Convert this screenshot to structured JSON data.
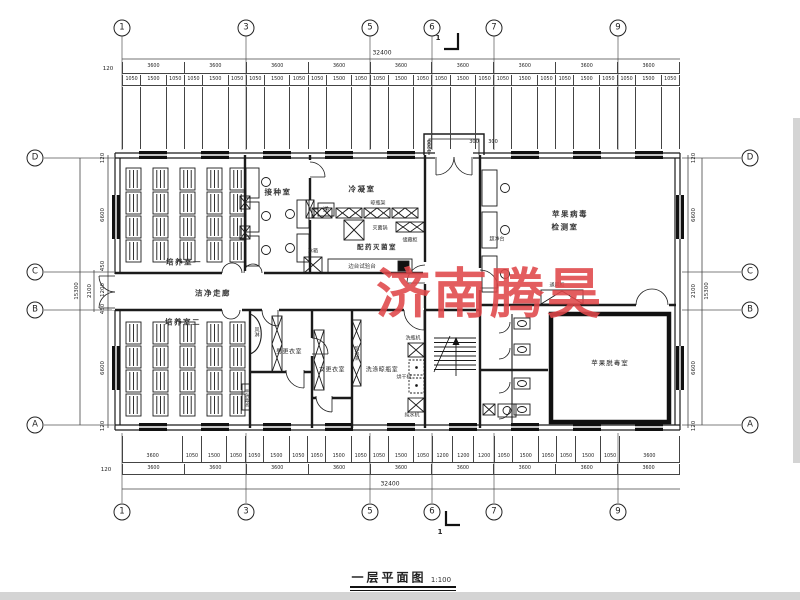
{
  "page": {
    "watermark": "济南腾昊",
    "watermark_color": "#e0474a",
    "title": "一层平面图",
    "scale": "1:100",
    "section_mark": "1"
  },
  "axes": {
    "top": [
      "1",
      "3",
      "5",
      "6",
      "7",
      "9"
    ],
    "bottom": [
      "1",
      "3",
      "5",
      "6",
      "7",
      "9"
    ],
    "left": [
      "D",
      "C",
      "B",
      "A"
    ],
    "right": [
      "D",
      "C",
      "B",
      "A"
    ]
  },
  "dims": {
    "top": {
      "total": "32400",
      "edge": "120",
      "bays": [
        "3600",
        "3600",
        "3600",
        "3600",
        "3600",
        "3600",
        "3600",
        "3600",
        "3600"
      ],
      "fine": [
        "1050",
        "1500",
        "1050",
        "1050",
        "1500",
        "1050",
        "1050",
        "1500",
        "1050",
        "1050",
        "1500",
        "1050",
        "1050",
        "1500",
        "1050",
        "1050",
        "1500",
        "1050",
        "1050",
        "1500",
        "1050",
        "1050",
        "1500",
        "1050",
        "1050",
        "1500",
        "1050"
      ]
    },
    "bottom": {
      "total": "32400",
      "edge": "120",
      "bays": [
        "3600",
        "3600",
        "3600",
        "3600",
        "3600",
        "3600",
        "3600",
        "3600",
        "3600"
      ],
      "fine": [
        "3600",
        "1050",
        "1500",
        "1050",
        "1050",
        "1500",
        "1050",
        "1050",
        "1500",
        "1050",
        "1050",
        "1500",
        "1050",
        "1200",
        "1200",
        "1200",
        "1050",
        "1500",
        "1050",
        "1050",
        "1500",
        "1050",
        "3600"
      ]
    },
    "left": {
      "edge_top": "120",
      "room_top": "6600",
      "seg1": "450",
      "seg2": "1200",
      "seg3": "450",
      "mid": "2100",
      "total": "15300",
      "room_bottom": "6600",
      "edge_bottom": "120"
    },
    "right": {
      "edge_top": "120",
      "room_top": "6600",
      "mid": "2100",
      "total": "15300",
      "room_bottom": "6600",
      "edge_bottom": "120"
    },
    "porch": {
      "width": "1200",
      "a": "300",
      "b": "300"
    }
  },
  "rooms": {
    "culture1": "培养室一",
    "inoculation": "接种室",
    "condensing": "冷凝室",
    "dispensing": "配药灭菌室",
    "corridor": "洁净走廊",
    "virus_line1": "苹果病毒",
    "virus_line2": "检测室",
    "culture2": "培养室二",
    "locker_m": "男更衣室",
    "locker_f": "女更衣室",
    "washing": "洗涤晾瓶室",
    "detox": "苹果脱毒室"
  },
  "equipment": {
    "pass": "递",
    "fridge": "冰箱",
    "bottle_rack": "晾瓶架",
    "sterilizer": "灭菌锅",
    "cabinet": "储藏柜",
    "side_bench": "边台试验台",
    "clean_bench": "超净台",
    "fume_hood": "通风柜",
    "air_shower": "风淋",
    "hand_wash": "手消毒池",
    "bottle_rack2": "晾瓶架",
    "bottle_washer": "洗瓶机",
    "dryer": "烘干机",
    "water_purifier": "纯水机"
  }
}
